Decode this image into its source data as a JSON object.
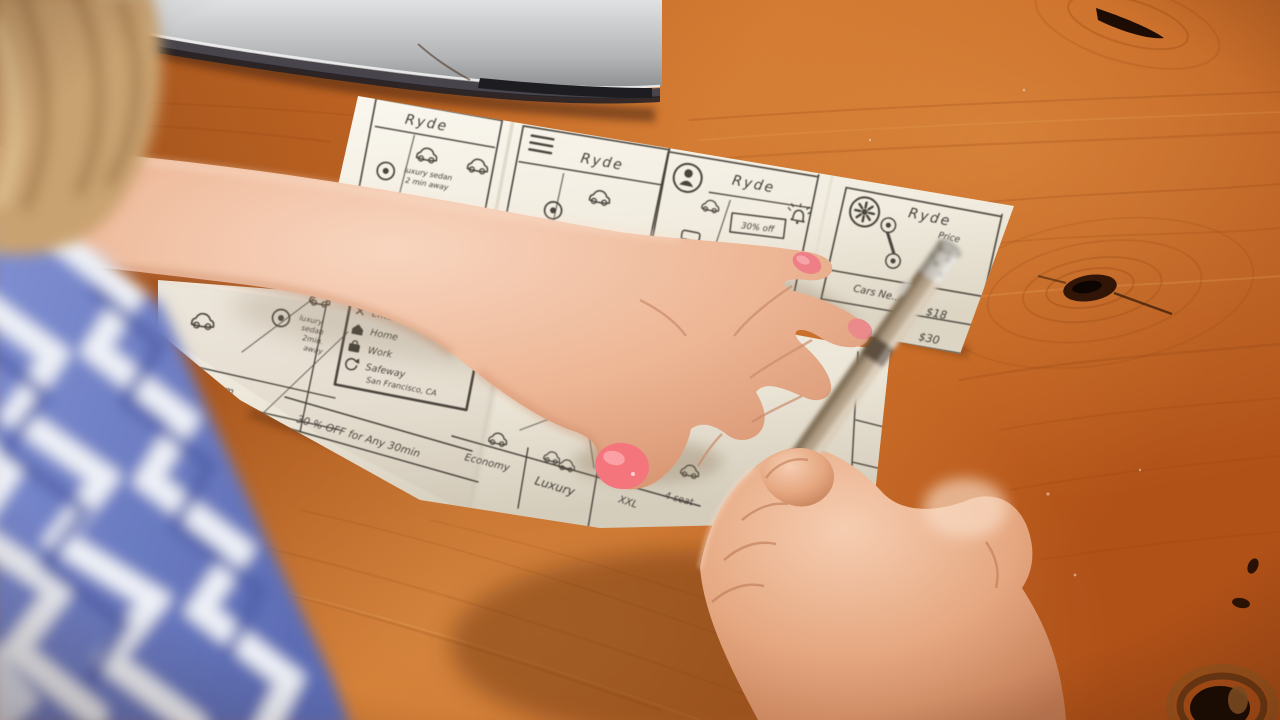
{
  "colors": {
    "wood": "#c46727",
    "wood_dark": "#8a3d12",
    "paper": "#f6f2e8",
    "ink": "#4a443c",
    "nail_polish": "#f4757e",
    "skin": "#edbb9d",
    "fabric_blue": "#6f7fc6",
    "fabric_white": "#eef1f7",
    "pen_body": "#b3a189",
    "laptop_silver": "#b9bbbd"
  },
  "icons": {
    "hamburger-icon": "three stacked lines",
    "profile-icon": "person silhouette in circle",
    "gear-icon": "asterisk gear in circle",
    "map-pin-icon": "circle with dot",
    "car-icon": "sketched car with wheels",
    "bell-icon": "ringing bell",
    "truck-icon": "van with wheels",
    "close-icon": "x mark",
    "home-icon": "house",
    "work-icon": "briefcase",
    "history-icon": "counterclockwise arrow",
    "keyhole-icon": "keyhole person in circle"
  },
  "sheet1": {
    "panel1": {
      "title": "Ryde",
      "pin_note_l1": "luxury sedan",
      "pin_note_l2": "2 min away"
    },
    "panel2": {
      "title": "Ryde"
    },
    "panel3": {
      "title": "Ryde",
      "promo": "30% off"
    },
    "panel4": {
      "title": "Ryde",
      "hint_l1": "Price",
      "hint_l2": "in ...",
      "list_row1": "Cars Ne...",
      "list_row2": "...d",
      "price1": "$18",
      "price2": "$30"
    }
  },
  "sheet2": {
    "panelA": {
      "footer": "...l  6pm"
    },
    "panelB": {
      "pin_l1": "luxury",
      "pin_l2": "sedan",
      "pin_l3": "2min.",
      "pin_l4": "away",
      "banner": "30 % OFF for Any 30min"
    },
    "favorites": {
      "item1": "Enter ...",
      "item2": "Home",
      "item3": "Work",
      "item4": "Safeway",
      "item4_sub": "San Francisco, CA"
    },
    "options": {
      "opt1": "Economy",
      "opt2": "Luxury",
      "opt3": "XXL",
      "opt3_sub": "4 seat"
    }
  }
}
